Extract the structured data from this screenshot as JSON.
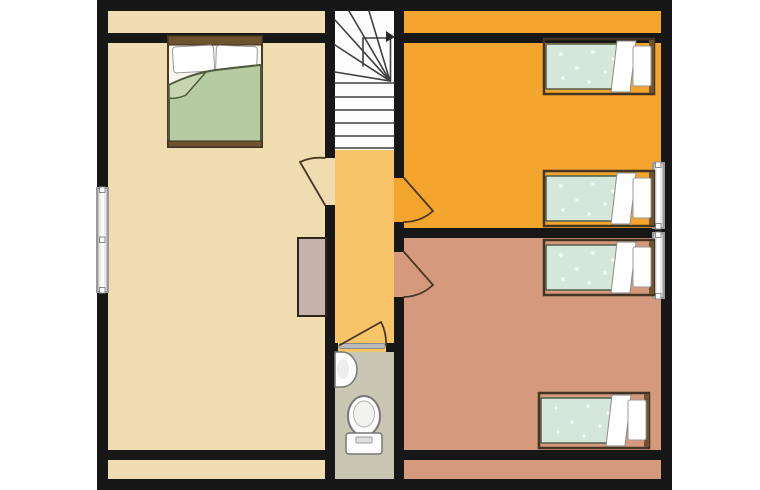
{
  "plan": {
    "kind": "residential-floor-plan",
    "rooms": [
      {
        "id": "left-bedroom",
        "label": "bedroom with double bed"
      },
      {
        "id": "stairwell",
        "label": "winder staircase"
      },
      {
        "id": "hallway",
        "label": "hallway / landing"
      },
      {
        "id": "orange-bedroom",
        "label": "bedroom with two single beds"
      },
      {
        "id": "salmon-bedroom",
        "label": "bedroom with two single beds"
      },
      {
        "id": "bathroom",
        "label": "wc with toilet and sink"
      }
    ],
    "fixtures": {
      "double_beds": 1,
      "single_beds": 4,
      "toilets": 1,
      "sinks": 1,
      "wardrobes": 1,
      "staircases": 1,
      "windows": 3,
      "doors": 4
    }
  },
  "palette": {
    "background": "#ffffff",
    "wall": "#171717",
    "beige_room": "#f0dcb1",
    "hallway": "#f8c468",
    "orange_room": "#f3a52d",
    "salmon_room": "#d59a7d",
    "bathroom": "#c9c6b3",
    "stairs": "#fdfdfd",
    "closet": "#c6b4ac",
    "double_duvet": "#b7cba3",
    "double_duvet_fold": "#c5d5b2",
    "single_duvet": "#d5e7db",
    "white": "#ffffff",
    "wood": "#6e532f",
    "bed_frame_line": "#443424",
    "window_glass": "#e9e9e9",
    "window_frame": "#9a9a9a",
    "door_line": "#4a3625",
    "door_leaf_gray": "#b9b9b9",
    "mattress": "#faf6ec",
    "fixture_fill": "#fdfdfd",
    "fixture_line": "#787878",
    "stair_line": "#3f3f3f"
  }
}
